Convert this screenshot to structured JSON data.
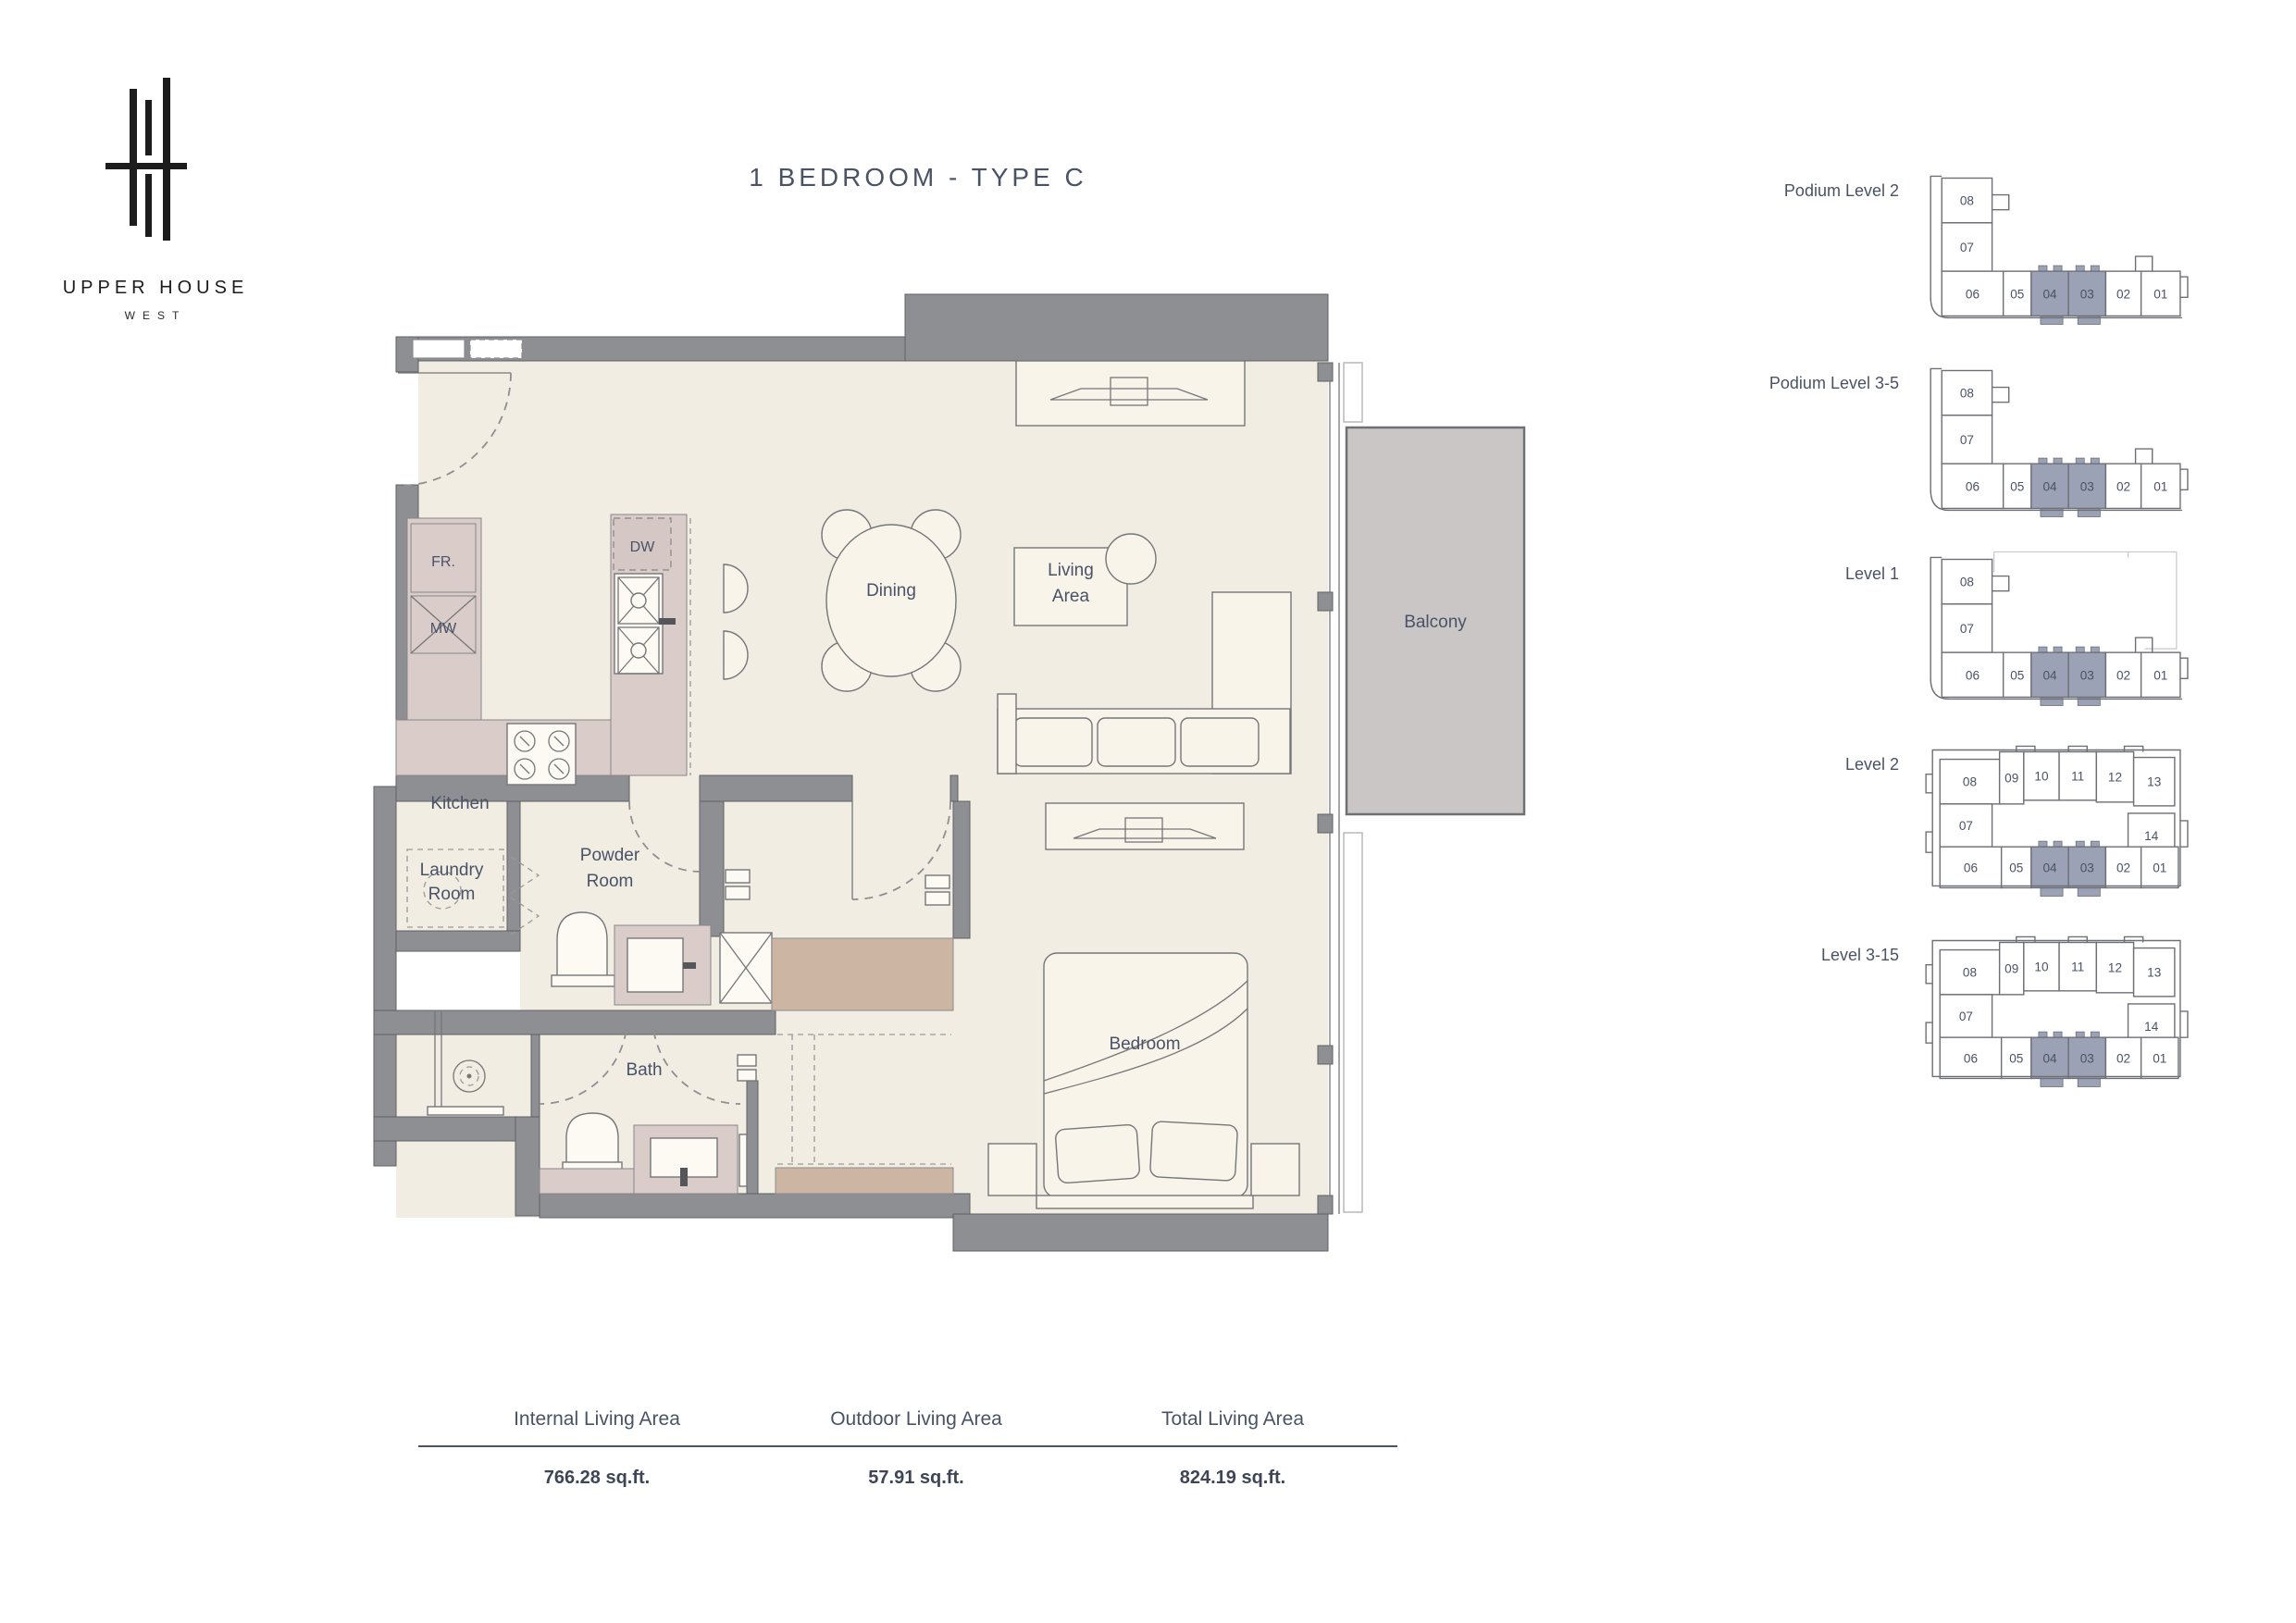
{
  "brand": {
    "name": "UPPER HOUSE",
    "sub": "WEST"
  },
  "title": "1 BEDROOM - TYPE C",
  "colors": {
    "label": "#4A5268",
    "wall": "#8E8F92",
    "floor": "#F1EDE2",
    "counter": "#DACCC8",
    "closet": "#CDB5A4",
    "balcony": "#C9C6C5",
    "keyplan_highlight": "#9BA2B6"
  },
  "floorplan": {
    "rooms": {
      "kitchen": "Kitchen",
      "laundry": [
        "Laundry",
        "Room"
      ],
      "powder": [
        "Powder",
        "Room"
      ],
      "bath": "Bath",
      "dining": "Dining",
      "living": [
        "Living",
        "Area"
      ],
      "bedroom": "Bedroom",
      "balcony": "Balcony",
      "fridge": "FR.",
      "microwave": "MW",
      "dishwasher": "DW"
    }
  },
  "keyplans": [
    {
      "label": "Podium Level 2",
      "type": "podium",
      "units": [
        "08",
        "07",
        "06",
        "05",
        "04",
        "03",
        "02",
        "01"
      ],
      "highlighted": [
        "04",
        "03"
      ]
    },
    {
      "label": "Podium Level 3-5",
      "type": "podium",
      "units": [
        "08",
        "07",
        "06",
        "05",
        "04",
        "03",
        "02",
        "01"
      ],
      "highlighted": [
        "04",
        "03"
      ]
    },
    {
      "label": "Level 1",
      "type": "level1",
      "units": [
        "08",
        "07",
        "06",
        "05",
        "04",
        "03",
        "02",
        "01"
      ],
      "highlighted": [
        "04",
        "03"
      ]
    },
    {
      "label": "Level 2",
      "type": "tower",
      "units": [
        "08",
        "09",
        "10",
        "11",
        "12",
        "13",
        "07",
        "14",
        "06",
        "05",
        "04",
        "03",
        "02",
        "01"
      ],
      "highlighted": [
        "04",
        "03"
      ]
    },
    {
      "label": "Level 3-15",
      "type": "tower",
      "units": [
        "08",
        "09",
        "10",
        "11",
        "12",
        "13",
        "07",
        "14",
        "06",
        "05",
        "04",
        "03",
        "02",
        "01"
      ],
      "highlighted": [
        "04",
        "03"
      ]
    }
  ],
  "areas": {
    "columns": [
      {
        "label": "Internal Living Area",
        "value": "766.28 sq.ft."
      },
      {
        "label": "Outdoor Living Area",
        "value": "57.91 sq.ft."
      },
      {
        "label": "Total Living Area",
        "value": "824.19 sq.ft."
      }
    ]
  }
}
